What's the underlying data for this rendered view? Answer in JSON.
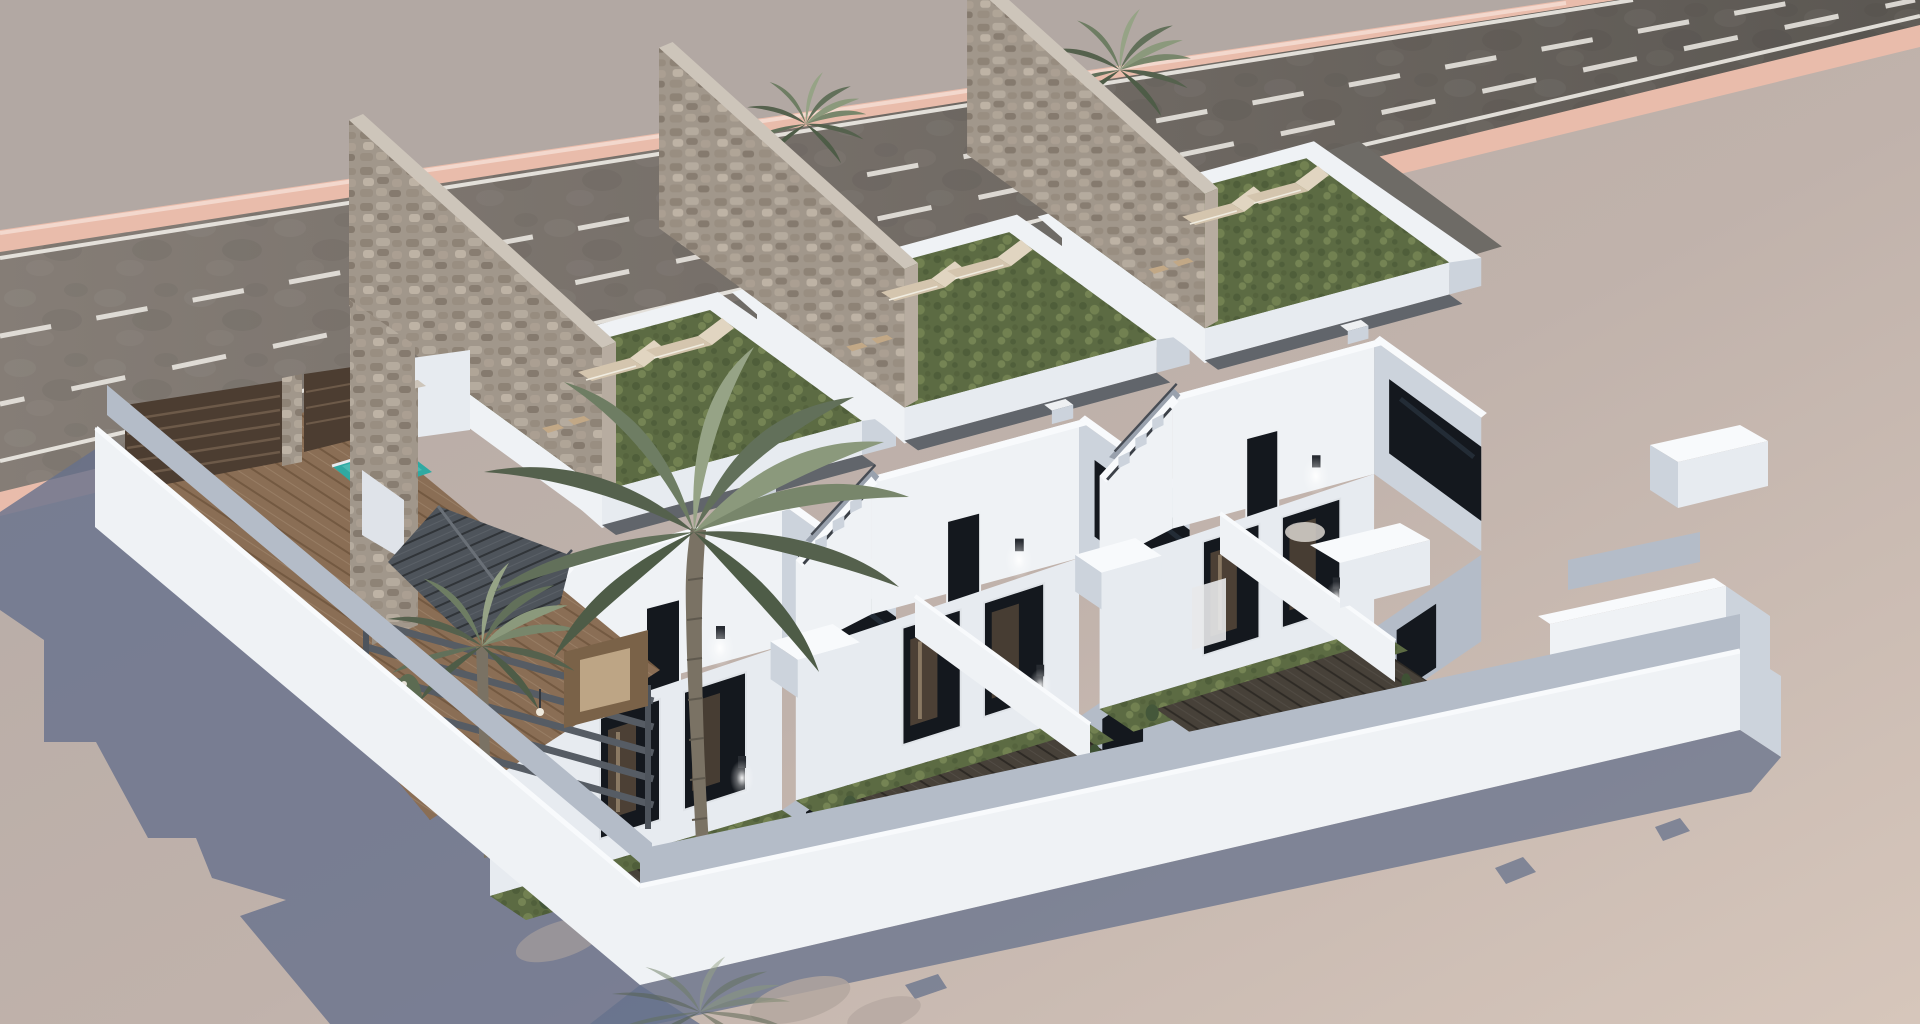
{
  "scene": {
    "type": "architectural-render",
    "description": "Aerial dusk view of three modern white two-storey townhouse villas with rooftop lawn terraces, stone privacy walls, lit wall lamps and front courtyards; the corner unit has a plunge pool, wooden deck drive, slatted gate, grey pergola, tiled canopy and palm trees; an asphalt road with pink kerbs runs behind the plot.",
    "villas_count": 3,
    "road": {
      "lanes": 3,
      "dashed_separators": 2,
      "kerb": "pink",
      "parked_car": "white"
    },
    "per_villa": {
      "sun_loungers": 2,
      "side_tables": 2,
      "wall_lamps_lit": 2,
      "roof_lawn": true,
      "stone_party_wall": true,
      "stair_parapet": true,
      "courtyard_garden": true
    },
    "corner_villa_extras": [
      "plunge-pool",
      "wood-deck",
      "slatted-gate",
      "pergola",
      "tiled-canopy",
      "stone-column",
      "large-palm",
      "small-palm"
    ],
    "lighting": "low sun from the right casting long blue shadows to the lower left"
  },
  "colors": {
    "ground_far": "#b2a8a3",
    "ground_near": "#d3c4ba",
    "road_left": "#847c75",
    "road_right": "#5d5954",
    "curb_pink": "#e9bcab",
    "curb_pink_light": "#f3d8cd",
    "lane_marking": "#efece6",
    "wall_white_lit": "#eff2f5",
    "wall_white": "#e7ebf0",
    "wall_shade": "#ccd3dc",
    "wall_inner_shade": "#b4bcc8",
    "wall_top": "#f8fafc",
    "mid_roof": "#61656b",
    "stone_base": "#a1978b",
    "stone_top": "#cdc5ba",
    "stone_edge": "#b7aca0",
    "grass": "#5c6b43",
    "walkway": "#6e6b66",
    "lounger": "#d4c5ae",
    "lounger_light": "#e1d5c1",
    "table_wicker": "#c2a886",
    "glass": "#14181e",
    "glass_reflect": "#2e3a46",
    "interior_warm": "#7a6248",
    "interior_light": "#c9b291",
    "deck": "#8a6e55",
    "patio_dark": "#474139",
    "pool": "#2fa9a2",
    "pool_light": "#5ec6bd",
    "gate_wood": "#4c3d31",
    "gate_slat": "#6d5a49",
    "pergola": "#565c64",
    "slate_roof": "#4e545b",
    "palm_dark": "#4e5c47",
    "palm_mid": "#6e7d63",
    "palm_light": "#96a386",
    "trunk": "#7a7264",
    "shadow": "#66718c",
    "car_white": "#eceff1",
    "ac_unit": "#eef0f2"
  }
}
